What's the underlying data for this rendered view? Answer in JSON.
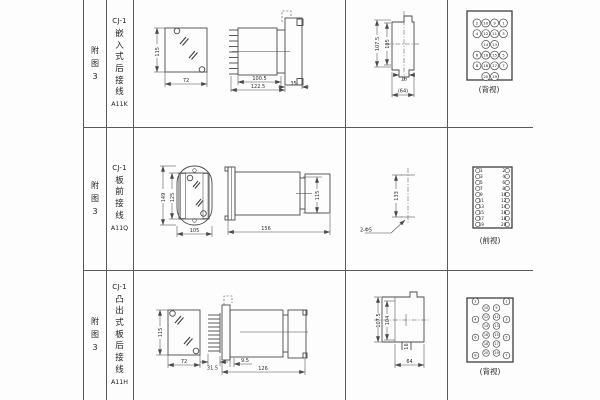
{
  "figure": {
    "fig_label_chars": [
      "附",
      "图",
      "3"
    ],
    "rows": [
      {
        "model": "CJ-1",
        "type_chars": [
          "嵌",
          "入",
          "式",
          "后",
          "接",
          "线"
        ],
        "code": "A11K",
        "view_label": "(背视)",
        "dims": {
          "front_h": "115",
          "front_w": "72",
          "side_body": "100.5",
          "side_total": "122.5",
          "side_flange": "35",
          "cut_outer": "107.5",
          "cut_inner": "105",
          "cut_notch": "16",
          "cut_width": "(64)"
        }
      },
      {
        "model": "CJ-1",
        "type_chars": [
          "板",
          "前",
          "接",
          "线"
        ],
        "code": "A11Q",
        "view_label": "(前视)",
        "dims": {
          "front_outer": "149",
          "front_inner": "125",
          "front_w": "105",
          "side_len": "156",
          "side_h": "115",
          "drill_pitch": "133",
          "drill_note": "2-Φ5"
        }
      },
      {
        "model": "CJ-1",
        "type_chars": [
          "凸",
          "出",
          "式",
          "板",
          "后",
          "接",
          "线"
        ],
        "code": "A11H",
        "view_label": "(背视)",
        "dims": {
          "front_h": "115",
          "front_w": "72",
          "side_pin": "31.5",
          "side_gap": "9.5",
          "side_len": "126",
          "cut_outer": "107.5",
          "cut_inner": "104",
          "cut_notch": "16",
          "cut_width": "64"
        }
      }
    ],
    "terminals": {
      "back_top": {
        "rows": [
          [
            "2",
            "10",
            "9",
            "1"
          ],
          [
            "4",
            "12",
            "11",
            "3"
          ],
          [
            "",
            "14",
            "13",
            ""
          ],
          [
            "6",
            "16",
            "15",
            "5"
          ],
          [
            "8",
            "18",
            "17",
            "7"
          ],
          [
            "",
            "20",
            "19",
            ""
          ]
        ]
      },
      "front_mid": {
        "left": [
          "1",
          "3",
          "5",
          "7",
          "9",
          "11",
          "13",
          "15",
          "17",
          "19"
        ],
        "right": [
          "2",
          "4",
          "6",
          "8",
          "10",
          "12",
          "14",
          "16",
          "18",
          "20"
        ]
      },
      "back_bottom": {
        "outer_left": [
          "2",
          "4",
          "6",
          "8"
        ],
        "inner_left": [
          "10",
          "12",
          "14",
          "16",
          "18",
          "20"
        ],
        "inner_right": [
          "9",
          "11",
          "13",
          "15",
          "17",
          "19"
        ],
        "outer_right": [
          "1",
          "3",
          "5",
          "7"
        ]
      }
    },
    "colors": {
      "line": "#4a4a4a",
      "text": "#2d2d2d",
      "bg": "#fdfdfd"
    }
  }
}
